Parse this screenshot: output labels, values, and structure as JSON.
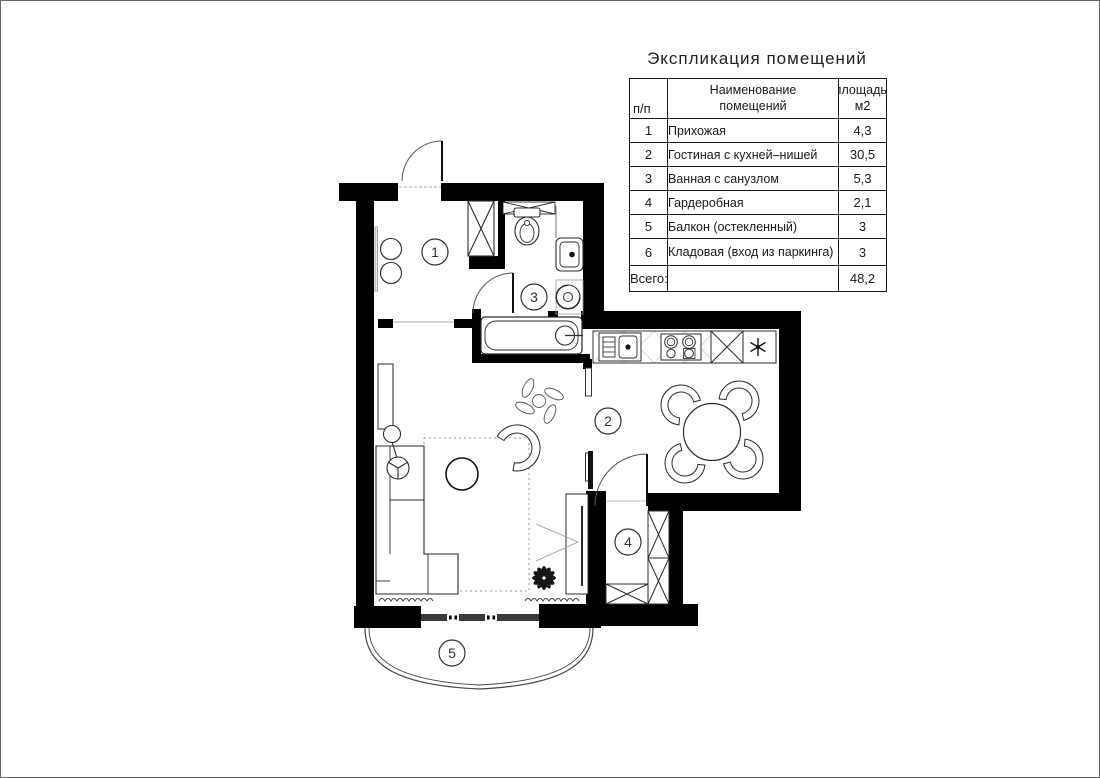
{
  "page": {
    "title": "Экспликация помещений"
  },
  "table": {
    "header": {
      "col_num": "п/п",
      "col_name_l1": "Наименование",
      "col_name_l2": "помещений",
      "col_area_l1": "площадь,",
      "col_area_l2": "м2"
    },
    "rows": [
      {
        "num": "1",
        "name": "Прихожая",
        "area": "4,3"
      },
      {
        "num": "2",
        "name": "Гостиная с кухней–нишей",
        "area": "30,5"
      },
      {
        "num": "3",
        "name": "Ванная с санузлом",
        "area": "5,3"
      },
      {
        "num": "4",
        "name": "Гардеробная",
        "area": "2,1"
      },
      {
        "num": "5",
        "name": "Балкон (остекленный)",
        "area": "3"
      },
      {
        "num": "6",
        "name": "Кладовая (вход из паркинга)",
        "area": "3"
      }
    ],
    "total": {
      "label": "Всего:",
      "area": "48,2"
    }
  },
  "plan": {
    "rooms": [
      {
        "label": "1"
      },
      {
        "label": "2"
      },
      {
        "label": "3"
      },
      {
        "label": "4"
      },
      {
        "label": "5"
      }
    ],
    "icons": [
      "entry-door",
      "bathroom-door",
      "wardrobe-door",
      "hall-cabinet",
      "stools",
      "mirror",
      "shelf-over-toilet",
      "toilet",
      "wash-basin",
      "washing-machine",
      "bathtub",
      "kitchen-sink",
      "cooktop",
      "tall-cabinet",
      "ceiling-light",
      "dining-table",
      "dining-chairs",
      "sofa",
      "floor-lamp",
      "wall-shelf",
      "coffee-table",
      "armchair",
      "rug",
      "tv-panel",
      "plant",
      "hanging-decor",
      "side-cabinet",
      "radiators",
      "window-unit",
      "balcony-outline",
      "wardrobe-cells"
    ],
    "colors": {
      "wall": "#000000",
      "outline": "#2b2b2b",
      "light_line": "#999999"
    }
  }
}
